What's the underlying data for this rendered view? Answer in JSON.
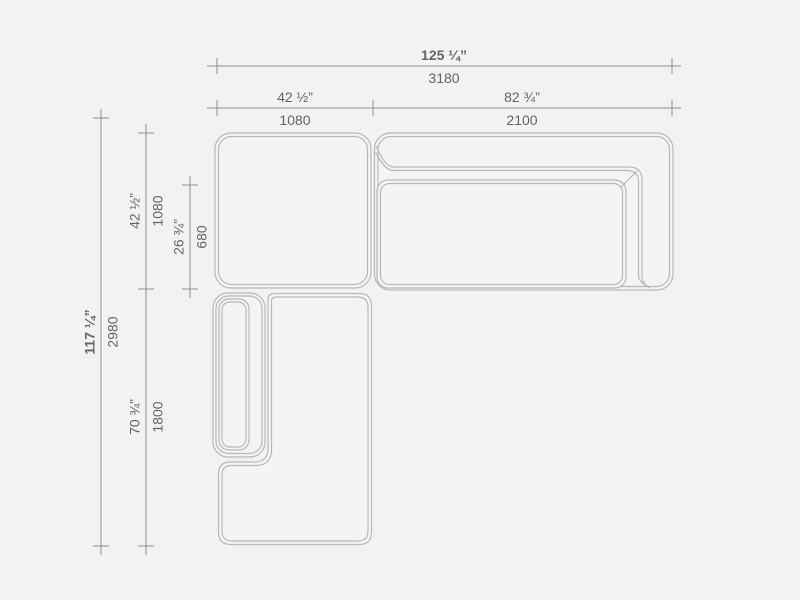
{
  "colors": {
    "background": "#f2f2f2",
    "shape_fill": "#f4f4f4",
    "shape_line": "#b5b9bb",
    "dimension_line": "#8d9093",
    "text": "#616467"
  },
  "drawing": {
    "dimensions": {
      "overall_width": {
        "inches": "125 ¼”",
        "mm": "3180"
      },
      "corner_module_width": {
        "inches": "42 ½”",
        "mm": "1080"
      },
      "sofa_module_width": {
        "inches": "82 ¾”",
        "mm": "2100"
      },
      "overall_depth": {
        "inches": "117 ¼”",
        "mm": "2980"
      },
      "corner_module_depth": {
        "inches": "42 ½”",
        "mm": "1080"
      },
      "seat_depth": {
        "inches": "26 ¾”",
        "mm": "680"
      },
      "chaise_length": {
        "inches": "70 ¾”",
        "mm": "1800"
      }
    }
  }
}
